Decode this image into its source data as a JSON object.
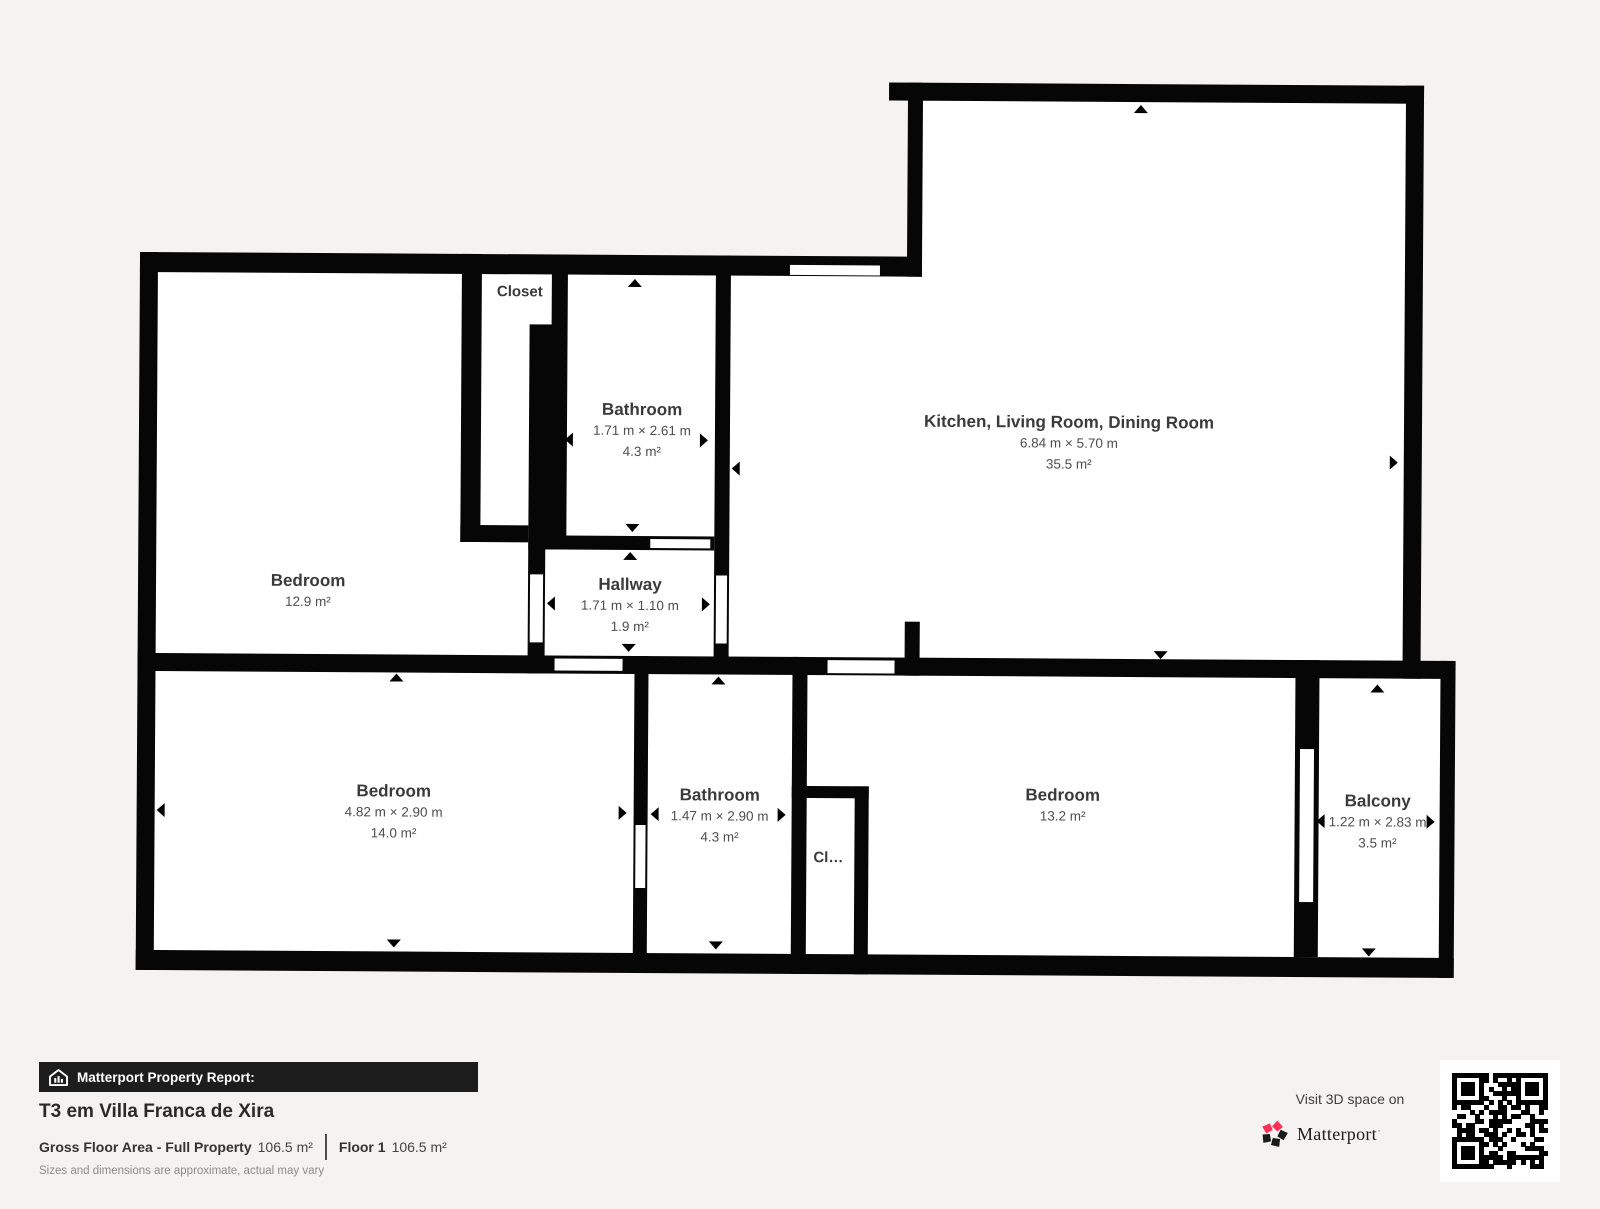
{
  "plan": {
    "rooms": [
      {
        "id": "bedroom-tl",
        "name": "Bedroom",
        "area": "12.9 m²"
      },
      {
        "id": "closet-tl",
        "name": "Closet"
      },
      {
        "id": "bathroom-tl",
        "name": "Bathroom",
        "dims": "1.71 m × 2.61 m",
        "area": "4.3 m²"
      },
      {
        "id": "hallway",
        "name": "Hallway",
        "dims": "1.71 m × 1.10 m",
        "area": "1.9 m²"
      },
      {
        "id": "kitchen-living-dining",
        "name": "Kitchen, Living Room, Dining Room",
        "dims": "6.84 m × 5.70 m",
        "area": "35.5 m²"
      },
      {
        "id": "bedroom-bl",
        "name": "Bedroom",
        "dims": "4.82 m × 2.90 m",
        "area": "14.0 m²"
      },
      {
        "id": "bathroom-b",
        "name": "Bathroom",
        "dims": "1.47 m × 2.90 m",
        "area": "4.3 m²"
      },
      {
        "id": "closet-b",
        "name": "Cl…"
      },
      {
        "id": "bedroom-br",
        "name": "Bedroom",
        "area": "13.2 m²"
      },
      {
        "id": "balcony",
        "name": "Balcony",
        "dims": "1.22 m × 2.83 m",
        "area": "3.5 m²"
      }
    ]
  },
  "footer": {
    "report_label": "Matterport Property Report:",
    "title": "T3 em Villa Franca de Xira",
    "gross_label": "Gross Floor Area - Full Property",
    "gross_value": "106.5 m²",
    "floor_label": "Floor 1",
    "floor_value": "106.5 m²",
    "disclaimer": "Sizes and dimensions are approximate, actual may vary",
    "visit_label": "Visit 3D space on",
    "brand": "Matterport"
  },
  "colors": {
    "background": "#f4f3f1",
    "wall": "#060606",
    "room_fill": "#ffffff",
    "label_text": "#3d3d3d",
    "brand_pink": "#ff3158",
    "banner_bg": "#1d1d1d"
  }
}
